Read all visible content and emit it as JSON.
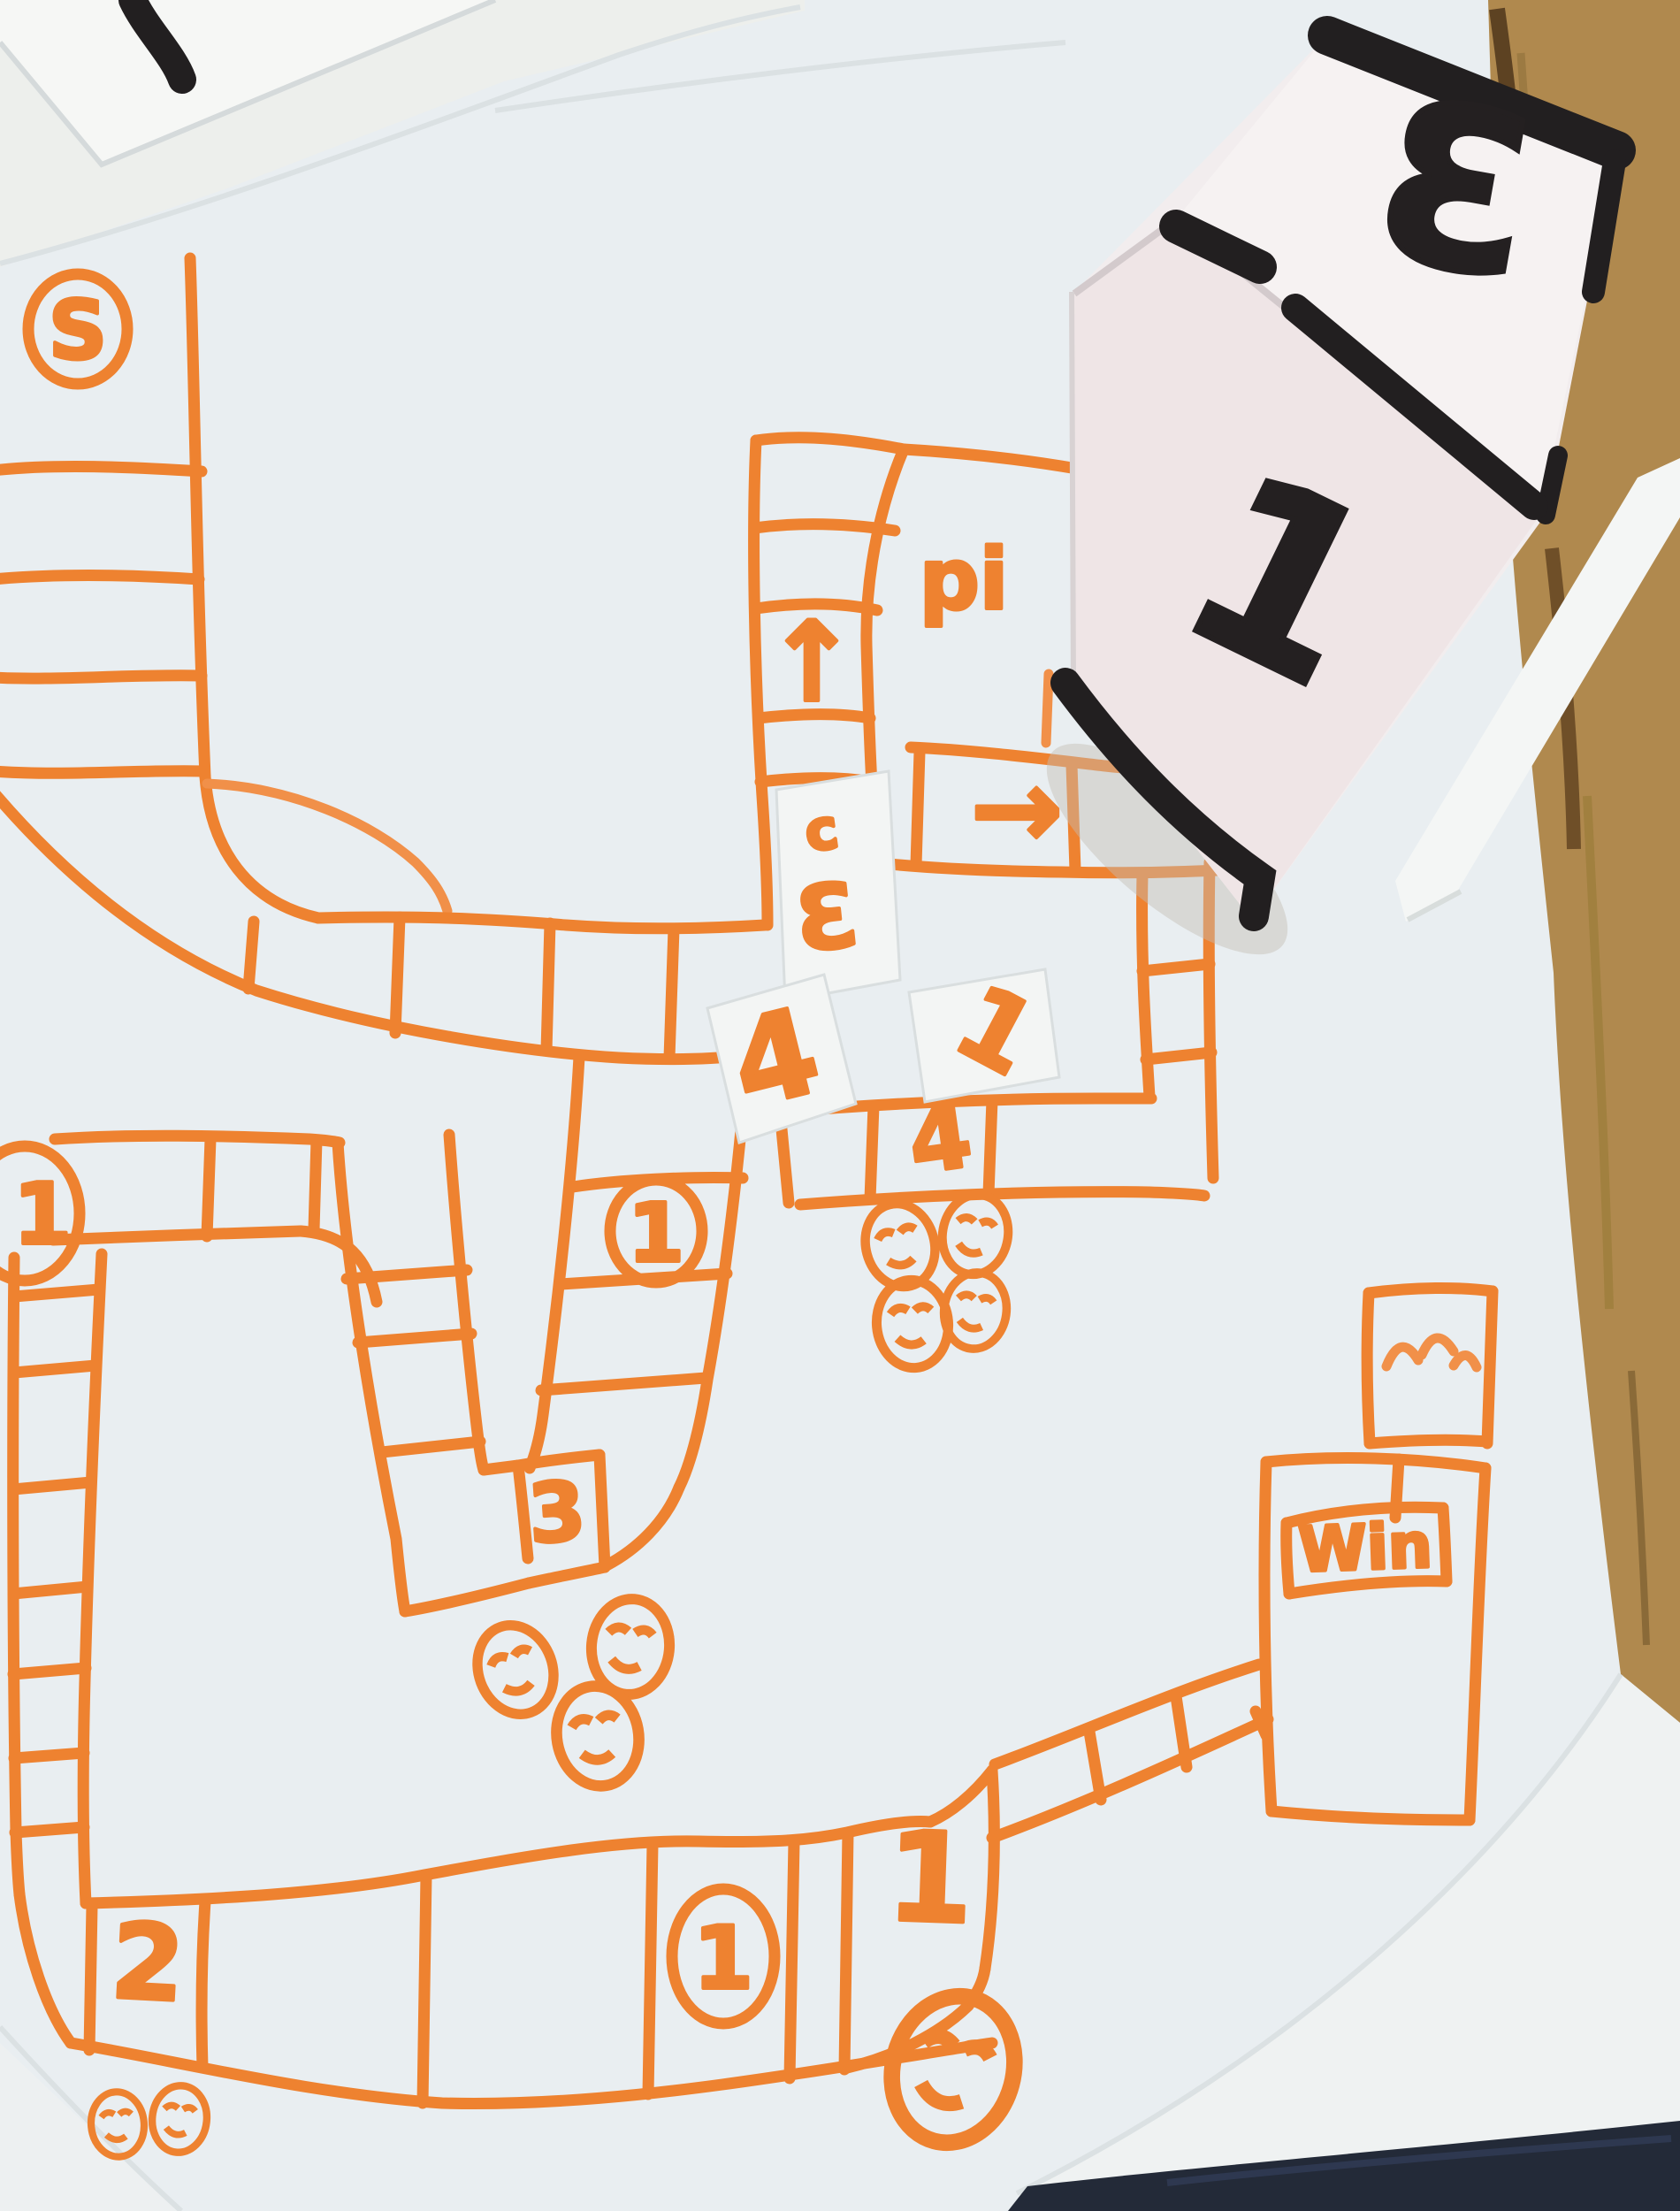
{
  "board": {
    "start_label": "S",
    "pit_label": "pi",
    "up_arrow": "↑",
    "right_arrow": "→",
    "cell_four": "4",
    "cell_three": "3",
    "cell_two": "2",
    "cell_one": "1",
    "circled_left": "1",
    "circled_middle": "1",
    "circled_bottom": "1",
    "win_label": "Win"
  },
  "cards": {
    "c_mark": "c",
    "three": "3",
    "four": "4",
    "one": "1"
  },
  "die": {
    "top_value": "3",
    "front_value": "1"
  },
  "tokens": {
    "face_count_total": 10,
    "groups": [
      {
        "near": "cell-4",
        "count": 4
      },
      {
        "near": "cell-3",
        "count": 3
      },
      {
        "near": "cell-2",
        "count": 2
      },
      {
        "near": "cell-1",
        "count": 1
      }
    ]
  },
  "objects": [
    "hand-drawn-game-board",
    "paper-die",
    "number-cards",
    "wooden-table",
    "paper-strip",
    "dark-object"
  ],
  "colors": {
    "marker_orange": "#EE8230",
    "die_ink_black": "#221F20",
    "paper": "#E9EEF1",
    "wood": "#B0894E",
    "navy_object": "#232A38"
  }
}
